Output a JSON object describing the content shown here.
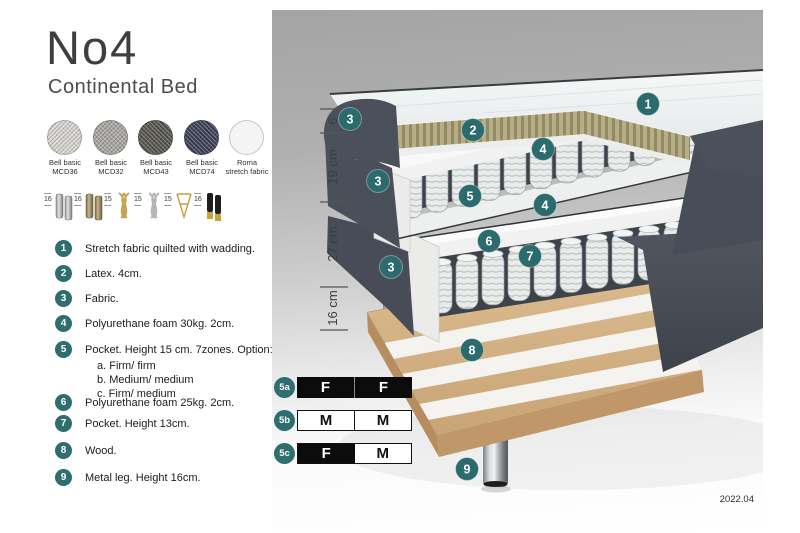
{
  "title": "No4",
  "subtitle": "Continental Bed",
  "accent_color": "#2f6e6e",
  "fabrics": [
    {
      "line1": "Bell basic",
      "line2": "MCD36",
      "color": "#d8d6d1"
    },
    {
      "line1": "Bell basic",
      "line2": "MCD32",
      "color": "#a9a7a2"
    },
    {
      "line1": "Bell basic",
      "line2": "MCD43",
      "color": "#56554f"
    },
    {
      "line1": "Bell basic",
      "line2": "MCD74",
      "color": "#3c4156"
    },
    {
      "line1": "Roma",
      "line2": "stretch fabric",
      "color": "#f4f4f4"
    }
  ],
  "legs": [
    {
      "height": "16",
      "icon": "cylinder-legs-silver"
    },
    {
      "height": "16",
      "icon": "cylinder-legs-bronze"
    },
    {
      "height": "15",
      "icon": "twist-leg-gold"
    },
    {
      "height": "15",
      "icon": "twist-leg-silver"
    },
    {
      "height": "15",
      "icon": "hairpin-leg-gold"
    },
    {
      "height": "16",
      "icon": "cylinder-legs-black-gold"
    }
  ],
  "parts": [
    {
      "num": "1",
      "text": "Stretch fabric quilted with wadding."
    },
    {
      "num": "2",
      "text": "Latex. 4cm."
    },
    {
      "num": "3",
      "text": "Fabric."
    },
    {
      "num": "4",
      "text": "Polyurethane foam 30kg. 2cm."
    },
    {
      "num": "5",
      "text": "Pocket. Height 15 cm. 7zones. Option:",
      "options": [
        "a. Firm/ firm",
        "b. Medium/ medium",
        "c. Firm/ medium"
      ]
    },
    {
      "num": "6",
      "text": "Polyurethane foam 25kg. 2cm."
    },
    {
      "num": "7",
      "text": "Pocket. Height 13cm."
    },
    {
      "num": "8",
      "text": "Wood."
    },
    {
      "num": "9",
      "text": "Metal leg. Height 16cm."
    }
  ],
  "diagram": {
    "measurements": [
      "6",
      "19 cm",
      "27 cm",
      "16 cm"
    ],
    "callouts": [
      "1",
      "2",
      "3",
      "3",
      "3",
      "4",
      "4",
      "5",
      "6",
      "7",
      "8",
      "9"
    ],
    "firmness": [
      {
        "id": "5a",
        "left": "F",
        "right": "F"
      },
      {
        "id": "5b",
        "left": "M",
        "right": "M"
      },
      {
        "id": "5c",
        "left": "F",
        "right": "M"
      }
    ],
    "version": "2022.04",
    "colors": {
      "fabric_dark": "#4a505a",
      "latex": "#b5ac84",
      "wood": "#d3b184",
      "spring": "#e9eceb"
    }
  }
}
